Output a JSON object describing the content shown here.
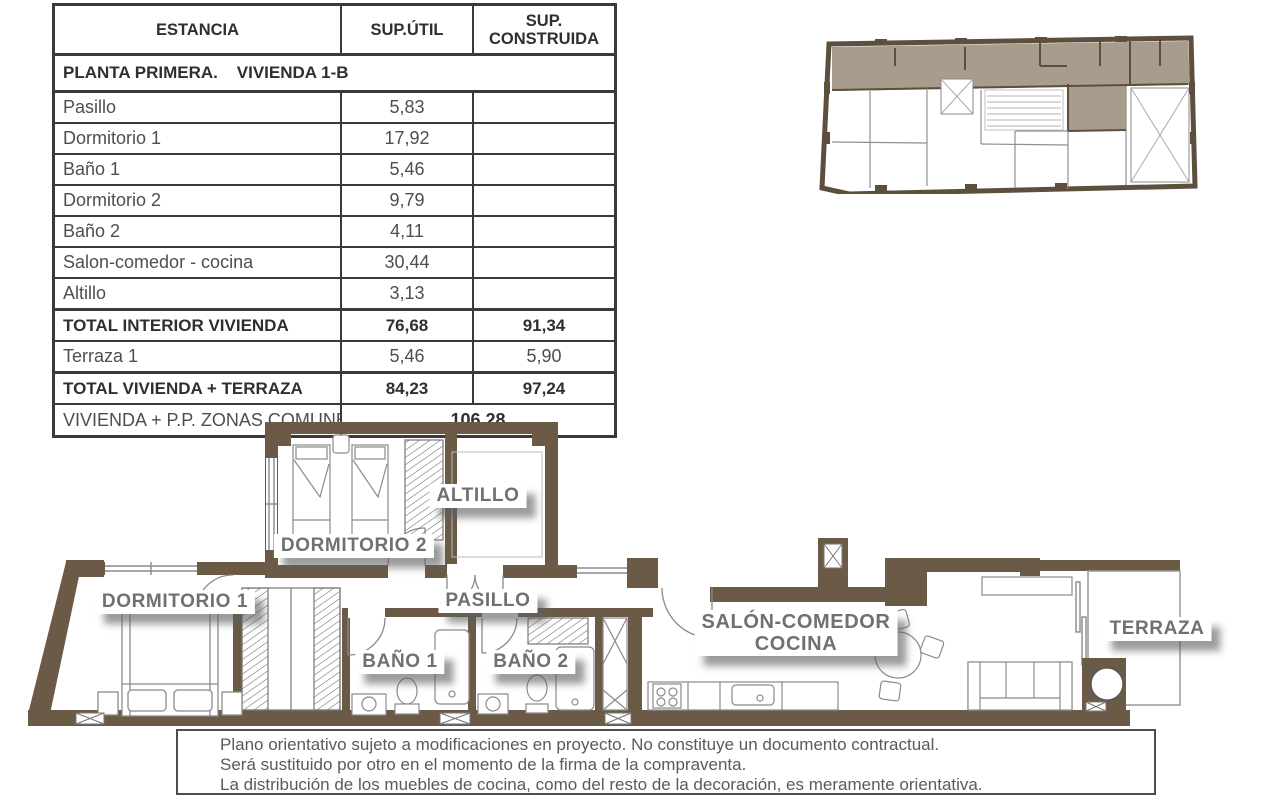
{
  "table": {
    "col_headers": [
      "ESTANCIA",
      "SUP.ÚTIL",
      "SUP. CONSTRUIDA"
    ],
    "section": "PLANTA PRIMERA.    VIVIENDA 1-B",
    "rows": [
      {
        "name": "Pasillo",
        "util": "5,83",
        "cons": ""
      },
      {
        "name": "Dormitorio 1",
        "util": "17,92",
        "cons": ""
      },
      {
        "name": "Baño 1",
        "util": "5,46",
        "cons": ""
      },
      {
        "name": "Dormitorio 2",
        "util": "9,79",
        "cons": ""
      },
      {
        "name": "Baño 2",
        "util": "4,11",
        "cons": ""
      },
      {
        "name": "Salon-comedor - cocina",
        "util": "30,44",
        "cons": ""
      },
      {
        "name": "Altillo",
        "util": "3,13",
        "cons": ""
      }
    ],
    "total_interior": {
      "name": "TOTAL INTERIOR VIVIENDA",
      "util": "76,68",
      "cons": "91,34"
    },
    "terraza_row": {
      "name": "Terraza 1",
      "util": "5,46",
      "cons": "5,90"
    },
    "total_terraza": {
      "name": "TOTAL VIVIENDA + TERRAZA",
      "util": "84,23",
      "cons": "97,24"
    },
    "comunes": {
      "name": "VIVIENDA + P.P. ZONAS COMUNES",
      "value": "106,28"
    }
  },
  "plan_labels": {
    "dormitorio1": "DORMITORIO 1",
    "dormitorio2": "DORMITORIO 2",
    "altillo": "ALTILLO",
    "pasillo": "PASILLO",
    "bano1": "BAÑO 1",
    "bano2": "BAÑO 2",
    "salon_line1": "SALÓN-COMEDOR",
    "salon_line2": "COCINA",
    "terraza": "TERRAZA"
  },
  "disclaimer": {
    "line1": "Plano orientativo sujeto a modificaciones en proyecto. No constituye un documento contractual.",
    "line2": "Será sustituido por otro en el momento de la firma de la compraventa.",
    "line3": "La distribución de los muebles de cocina, como del resto de la decoración, es meramente orientativa."
  },
  "colors": {
    "wall_brown": "#6b5b46",
    "keyplan_wall": "#5d4e3e",
    "keyplan_highlight": "#a89d8c",
    "label_text": "#707070",
    "thin_line": "#8a8a8a"
  }
}
